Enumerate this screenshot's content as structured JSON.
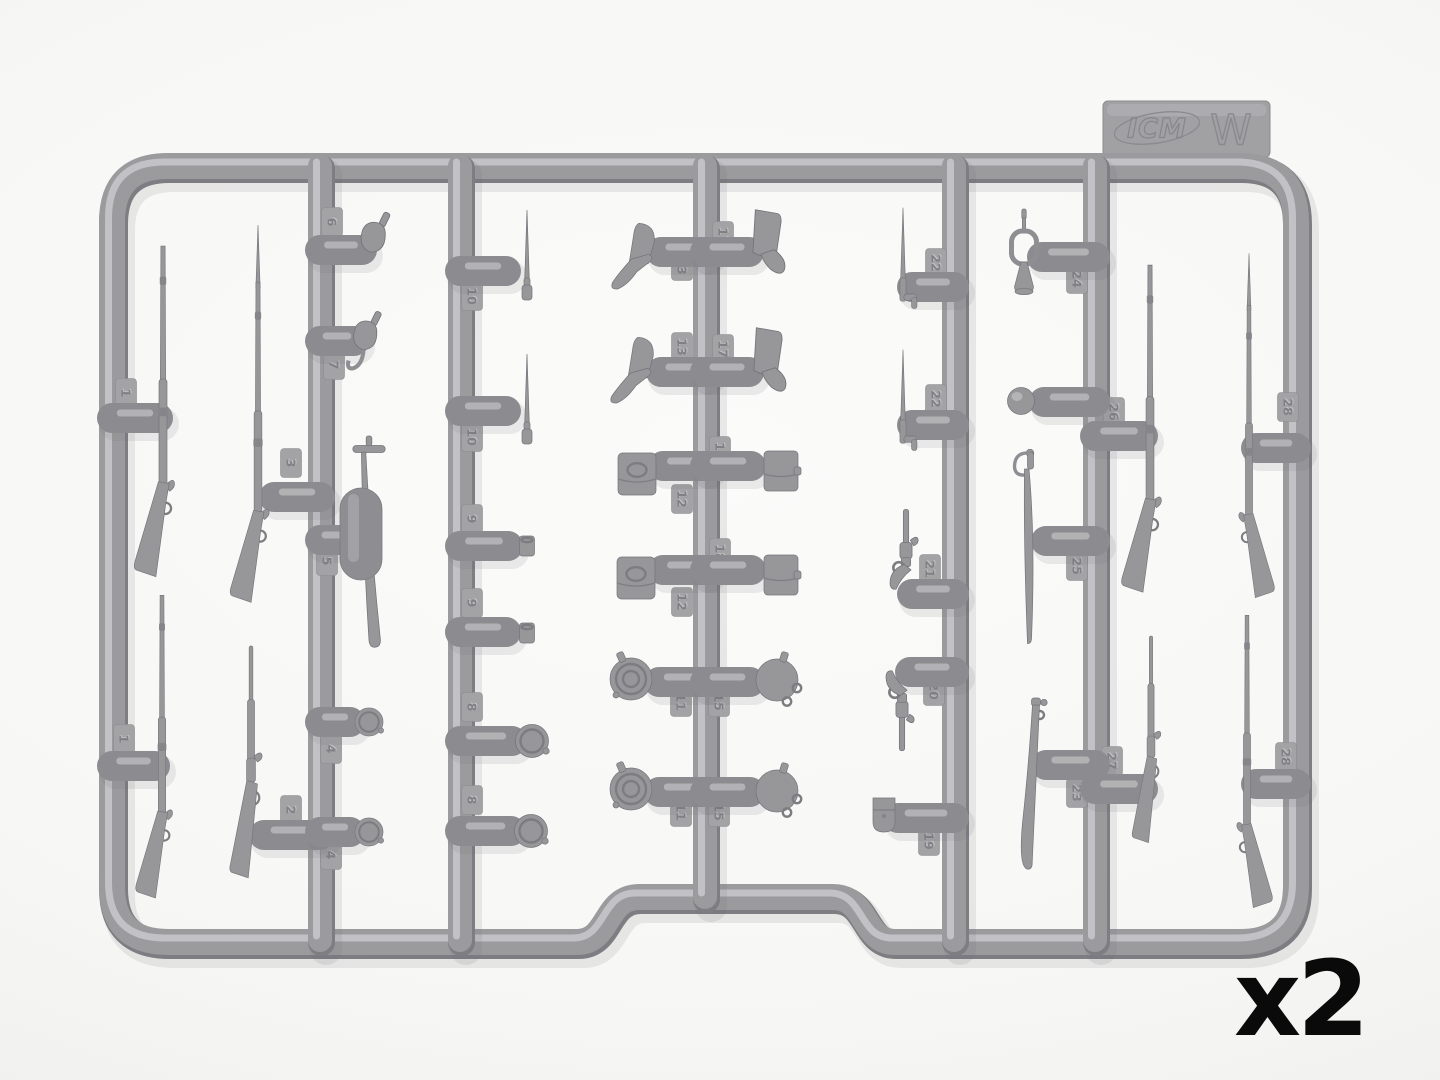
{
  "image_description": "Photograph of an injection-molded plastic model kit sprue with miniature 19th-century weapons and accessories",
  "brand_tab": {
    "brand": "ICM",
    "sprue_letter": "W"
  },
  "quantity": {
    "label": "x2"
  },
  "palette": {
    "background": "#f7f7f5",
    "plastic": "#9b9b9e",
    "plastic_dark": "#7d7d82",
    "plastic_light": "#c7c7ca",
    "gate": "#8c8c90",
    "tag": "#a3a3a6",
    "label_text": "#0a0a0b"
  },
  "sprue": {
    "frame": {
      "left": 112,
      "top": 166,
      "right": 1296,
      "bottom": 942,
      "r": 56,
      "notch": {
        "x1": 577,
        "x2": 895,
        "top": 897
      }
    },
    "runners": [
      {
        "x": 320,
        "y1": 166,
        "y2": 940
      },
      {
        "x": 460,
        "y1": 166,
        "y2": 940
      },
      {
        "x": 705,
        "y1": 166,
        "y2": 897
      },
      {
        "x": 954,
        "y1": 166,
        "y2": 940
      },
      {
        "x": 1095,
        "y1": 166,
        "y2": 940
      }
    ],
    "gates": [
      [
        112,
        418,
        158,
        418
      ],
      [
        112,
        766,
        155,
        766
      ],
      [
        274,
        497,
        320,
        497
      ],
      [
        264,
        835,
        320,
        835
      ],
      [
        320,
        250,
        362,
        250
      ],
      [
        320,
        341,
        354,
        341
      ],
      [
        320,
        540,
        348,
        540
      ],
      [
        320,
        722,
        350,
        722
      ],
      [
        320,
        832,
        350,
        832
      ],
      [
        460,
        271,
        506,
        271
      ],
      [
        460,
        411,
        506,
        411
      ],
      [
        460,
        546,
        508,
        546
      ],
      [
        460,
        632,
        506,
        632
      ],
      [
        460,
        741,
        512,
        741
      ],
      [
        460,
        831,
        511,
        831
      ],
      [
        661,
        252,
        705,
        252
      ],
      [
        705,
        252,
        749,
        252
      ],
      [
        661,
        372,
        705,
        372
      ],
      [
        705,
        372,
        749,
        372
      ],
      [
        663,
        466,
        705,
        466
      ],
      [
        705,
        466,
        751,
        466
      ],
      [
        663,
        570,
        705,
        570
      ],
      [
        705,
        570,
        751,
        570
      ],
      [
        659,
        682,
        705,
        682
      ],
      [
        705,
        682,
        750,
        682
      ],
      [
        659,
        792,
        705,
        792
      ],
      [
        705,
        792,
        750,
        792
      ],
      [
        912,
        287,
        954,
        287
      ],
      [
        912,
        425,
        954,
        425
      ],
      [
        912,
        594,
        954,
        594
      ],
      [
        910,
        672,
        954,
        672
      ],
      [
        898,
        818,
        954,
        818
      ],
      [
        1042,
        257,
        1095,
        257
      ],
      [
        1044,
        402,
        1095,
        402
      ],
      [
        1046,
        541,
        1095,
        541
      ],
      [
        1046,
        765,
        1095,
        765
      ],
      [
        1095,
        436,
        1143,
        436
      ],
      [
        1095,
        789,
        1143,
        789
      ],
      [
        1256,
        448,
        1296,
        448
      ],
      [
        1256,
        784,
        1296,
        784
      ]
    ],
    "parts": [
      {
        "name": "rifle-musket",
        "type": "musket",
        "x": 163,
        "y": 248,
        "s": 0.95
      },
      {
        "name": "rifle-musket",
        "type": "musket",
        "x": 162,
        "y": 597,
        "s": 0.87
      },
      {
        "name": "musket-with-bayonet",
        "type": "musketB",
        "x": 258,
        "y": 284,
        "s": 0.92
      },
      {
        "name": "lever-action-rifle",
        "type": "lever",
        "x": 251,
        "y": 646,
        "s": 0.92
      },
      {
        "name": "powder-flask",
        "type": "flask",
        "x": 374,
        "y": 241,
        "s": 1.25
      },
      {
        "name": "powder-flask-with-hook",
        "type": "flaskh",
        "x": 366,
        "y": 339,
        "s": 1.2
      },
      {
        "name": "sword-with-crossguard",
        "type": "swordT",
        "x": 369,
        "y": 449,
        "s": 1.08
      },
      {
        "name": "runner-capsule",
        "type": "capsule",
        "x": 361,
        "y": 488,
        "s": 1
      },
      {
        "name": "canteen-half",
        "type": "disc",
        "x": 369,
        "y": 722,
        "s": 0.85
      },
      {
        "name": "canteen-half",
        "type": "disc",
        "x": 369,
        "y": 832,
        "s": 0.85
      },
      {
        "name": "spike-bayonet",
        "type": "pinbay",
        "x": 527,
        "y": 290,
        "s": 1
      },
      {
        "name": "spike-bayonet",
        "type": "pinbay",
        "x": 527,
        "y": 434,
        "s": 1
      },
      {
        "name": "cup",
        "type": "cup",
        "x": 527,
        "y": 546,
        "s": 1
      },
      {
        "name": "cup",
        "type": "cup",
        "x": 527,
        "y": 633,
        "s": 1
      },
      {
        "name": "canteen-half",
        "type": "disc",
        "x": 532,
        "y": 741,
        "s": 1
      },
      {
        "name": "canteen-half",
        "type": "disc",
        "x": 531,
        "y": 831,
        "s": 1
      },
      {
        "name": "slouch-hat",
        "type": "slouch",
        "x": 640,
        "y": 258,
        "s": 1.05
      },
      {
        "name": "slouch-hat",
        "type": "slouch",
        "x": 639,
        "y": 372,
        "s": 1.05
      },
      {
        "name": "kepi-cap",
        "type": "kepi",
        "x": 766,
        "y": 251,
        "s": 1.25
      },
      {
        "name": "kepi-cap",
        "type": "kepi",
        "x": 767,
        "y": 369,
        "s": 1.25
      },
      {
        "name": "cartridge-box-US",
        "type": "boxus",
        "x": 637,
        "y": 474,
        "s": 1
      },
      {
        "name": "cartridge-box-US",
        "type": "boxus",
        "x": 636,
        "y": 578,
        "s": 1
      },
      {
        "name": "cartridge-box",
        "type": "boxpl",
        "x": 781,
        "y": 471,
        "s": 1
      },
      {
        "name": "cartridge-box",
        "type": "boxpl",
        "x": 781,
        "y": 575,
        "s": 1
      },
      {
        "name": "canteen",
        "type": "cant1",
        "x": 631,
        "y": 679,
        "s": 1
      },
      {
        "name": "canteen",
        "type": "cant1",
        "x": 631,
        "y": 789,
        "s": 1
      },
      {
        "name": "canteen-with-loops",
        "type": "cant2",
        "x": 777,
        "y": 680,
        "s": 1
      },
      {
        "name": "canteen-with-loops",
        "type": "cant2",
        "x": 777,
        "y": 791,
        "s": 1
      },
      {
        "name": "socket-bayonet",
        "type": "sockbay",
        "x": 903,
        "y": 294,
        "s": 0.9
      },
      {
        "name": "socket-bayonet",
        "type": "sockbay",
        "x": 903,
        "y": 436,
        "s": 0.9
      },
      {
        "name": "revolver",
        "type": "revolver",
        "x": 906,
        "y": 560,
        "s": 1.1
      },
      {
        "name": "revolver",
        "type": "revolver",
        "x": 902,
        "y": 700,
        "s": 1.1,
        "flipY": true
      },
      {
        "name": "cap-pouch",
        "type": "holster",
        "x": 884,
        "y": 814,
        "s": 1
      },
      {
        "name": "bugle",
        "type": "bugle",
        "x": 1024,
        "y": 252,
        "s": 1
      },
      {
        "name": "round-knob",
        "type": "ball",
        "x": 1021,
        "y": 401,
        "s": 1
      },
      {
        "name": "cavalry-saber",
        "type": "saber",
        "x": 1028,
        "y": 456,
        "s": 1
      },
      {
        "name": "saber-scabbard",
        "type": "scab",
        "x": 1036,
        "y": 698,
        "s": 1
      },
      {
        "name": "rifle-musket",
        "type": "musket",
        "x": 1150,
        "y": 267,
        "s": 0.94
      },
      {
        "name": "musket-with-bayonet",
        "type": "musketB",
        "x": 1249,
        "y": 307,
        "s": 0.84,
        "flipX": true
      },
      {
        "name": "carbine",
        "type": "lever",
        "x": 1151,
        "y": 636,
        "s": 0.82
      },
      {
        "name": "rifle-musket",
        "type": "musket",
        "x": 1247,
        "y": 617,
        "s": 0.84,
        "flipX": true
      }
    ],
    "part_number_tags": [
      {
        "label": "1",
        "x": 126,
        "y": 393
      },
      {
        "label": "1",
        "x": 124,
        "y": 739
      },
      {
        "label": "3",
        "x": 291,
        "y": 463
      },
      {
        "label": "2",
        "x": 291,
        "y": 810
      },
      {
        "label": "6",
        "x": 332,
        "y": 222
      },
      {
        "label": "7",
        "x": 334,
        "y": 365
      },
      {
        "label": "5",
        "x": 327,
        "y": 561
      },
      {
        "label": "4",
        "x": 331,
        "y": 749
      },
      {
        "label": "4",
        "x": 331,
        "y": 855
      },
      {
        "label": "10",
        "x": 472,
        "y": 296
      },
      {
        "label": "10",
        "x": 472,
        "y": 437
      },
      {
        "label": "9",
        "x": 472,
        "y": 519
      },
      {
        "label": "9",
        "x": 472,
        "y": 603
      },
      {
        "label": "8",
        "x": 472,
        "y": 707
      },
      {
        "label": "8",
        "x": 472,
        "y": 800
      },
      {
        "label": "13",
        "x": 682,
        "y": 266
      },
      {
        "label": "17",
        "x": 723,
        "y": 236
      },
      {
        "label": "13",
        "x": 682,
        "y": 347
      },
      {
        "label": "17",
        "x": 723,
        "y": 349
      },
      {
        "label": "12",
        "x": 682,
        "y": 499
      },
      {
        "label": "16",
        "x": 720,
        "y": 451
      },
      {
        "label": "12",
        "x": 682,
        "y": 602
      },
      {
        "label": "18",
        "x": 720,
        "y": 553
      },
      {
        "label": "11",
        "x": 681,
        "y": 702
      },
      {
        "label": "15",
        "x": 719,
        "y": 702
      },
      {
        "label": "11",
        "x": 681,
        "y": 812
      },
      {
        "label": "15",
        "x": 719,
        "y": 812
      },
      {
        "label": "22",
        "x": 936,
        "y": 263
      },
      {
        "label": "22",
        "x": 936,
        "y": 399
      },
      {
        "label": "21",
        "x": 930,
        "y": 569
      },
      {
        "label": "20",
        "x": 934,
        "y": 691
      },
      {
        "label": "19",
        "x": 929,
        "y": 841
      },
      {
        "label": "24",
        "x": 1077,
        "y": 279
      },
      {
        "label": "25",
        "x": 1077,
        "y": 566
      },
      {
        "label": "23",
        "x": 1077,
        "y": 793
      },
      {
        "label": "26",
        "x": 1114,
        "y": 412
      },
      {
        "label": "27",
        "x": 1112,
        "y": 761
      },
      {
        "label": "28",
        "x": 1288,
        "y": 407
      },
      {
        "label": "28",
        "x": 1286,
        "y": 757
      }
    ]
  }
}
